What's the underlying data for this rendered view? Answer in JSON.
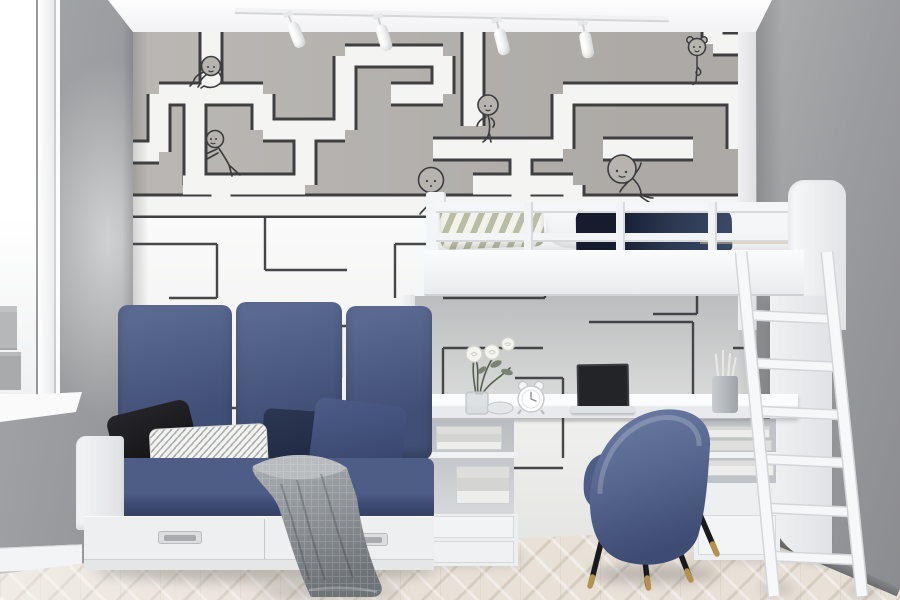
{
  "meta": {
    "scene": "kids-bedroom-interior-photo",
    "description": "Bright children's room with maze-print wallpaper, white loft bed with ladder and desk underneath, navy daybed sofa, blue velvet chair, herringbone floor"
  },
  "palette": {
    "wall-grey": "#a6a7aa",
    "wall-grey-dark": "#97989b",
    "wallpaper-grey": "#b4b1ad",
    "maze-line": "#3f3f42",
    "navy": "#4c5b84",
    "navy-dark": "#2c3850",
    "black-pillow": "#0f0f12",
    "throw-grey": "#8f9499",
    "chair-blue": "#5a6a93",
    "floor": "#e8e1d8",
    "gold": "#b5914b",
    "furniture-white": "#eef0f2"
  },
  "scene": {
    "window": {
      "position": "left",
      "frame": "white",
      "view": "city building glimpse",
      "sill": "white"
    },
    "ceiling": {
      "track_light_spots": 4,
      "color": "white"
    },
    "wallpaper": {
      "upper_band": "grey with white maze corridors outlined in black",
      "lower_band": "white with thin black maze lines",
      "doodles": [
        "two small hearts"
      ],
      "figures": [
        {
          "id": "crawling-kid",
          "pose": "crawling on a maze corridor",
          "area": "upper left"
        },
        {
          "id": "pushing-kid",
          "pose": "pushing against a maze wall",
          "area": "left"
        },
        {
          "id": "leaning-kid",
          "pose": "leaning on a corridor, legs crossed",
          "area": "center"
        },
        {
          "id": "walking-kid",
          "pose": "big-headed kid walking, half hidden by bed post",
          "area": "center"
        },
        {
          "id": "yoga-girl",
          "pose": "girl with buns standing on one leg",
          "area": "upper right"
        },
        {
          "id": "sitting-kid",
          "pose": "slumped sitting kid reaching up",
          "area": "right"
        }
      ]
    },
    "loft_bed": {
      "color": "white",
      "railing": {
        "rails": 2,
        "balusters": 3
      },
      "bedding": [
        "striped green-white pillow",
        "white pillow",
        "navy blanket",
        "white duvet"
      ],
      "headboard": "rounded white panel",
      "ladder": {
        "rails": 2,
        "rungs": 6,
        "color": "white",
        "lean": "against right side"
      }
    },
    "desk": {
      "top": "white slab under loft",
      "left_unit": {
        "open_shelf_books": 2,
        "drawers": 2
      },
      "right_unit": {
        "book_stacks": 2,
        "drawer": 1
      },
      "items": [
        "white roses in glass vase",
        "glass bowl",
        "white twin-bell alarm clock",
        "open laptop, dark screen",
        "grey pencil cup with pencils"
      ]
    },
    "chair": {
      "type": "barrel velvet chair seen from behind",
      "color": "blue",
      "legs": "black tapered with brass tips",
      "count_legs": 4
    },
    "sofa": {
      "type": "white daybed",
      "cushions": "navy blue",
      "pillows": [
        "black",
        "white zigzag-pattern lumbar",
        "dark navy",
        "navy"
      ],
      "throw": "grey knit blanket draping to floor",
      "drawers": 2,
      "handles": "inset metal"
    },
    "floor": "light herringbone wood",
    "walls": "grey"
  }
}
